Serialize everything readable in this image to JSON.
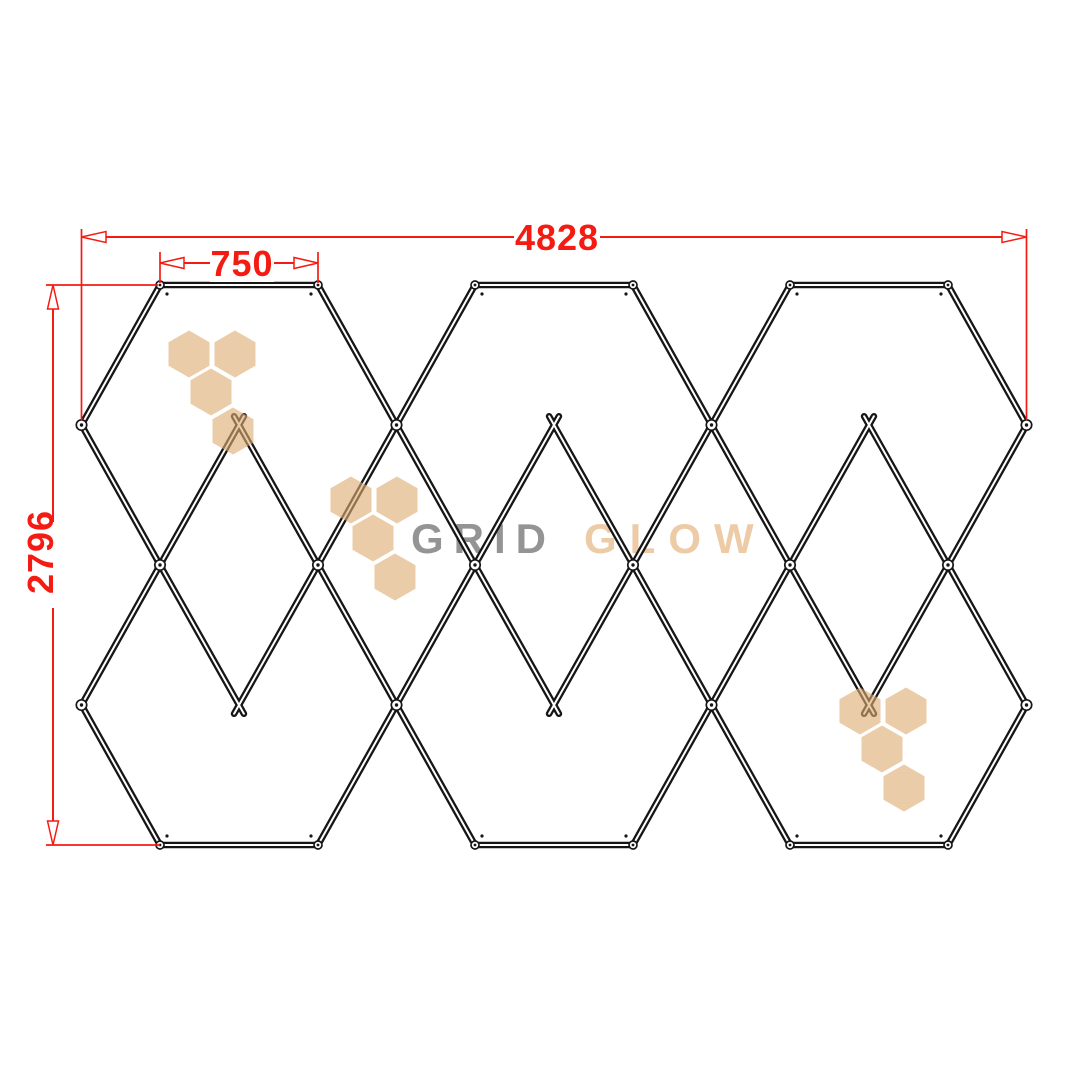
{
  "drawing": {
    "dimensions": {
      "overall_width": "4828",
      "cell_top_edge": "750",
      "overall_height": "2796"
    },
    "brand": {
      "part1": "GRID",
      "part2": "GLOW"
    },
    "colors": {
      "dimension_red": "#f41b12",
      "frame_black": "#161616",
      "watermark_beige": "#dfac72",
      "brand_gray": "#8c8c8c",
      "brand_beige": "#ecc9a2"
    }
  }
}
